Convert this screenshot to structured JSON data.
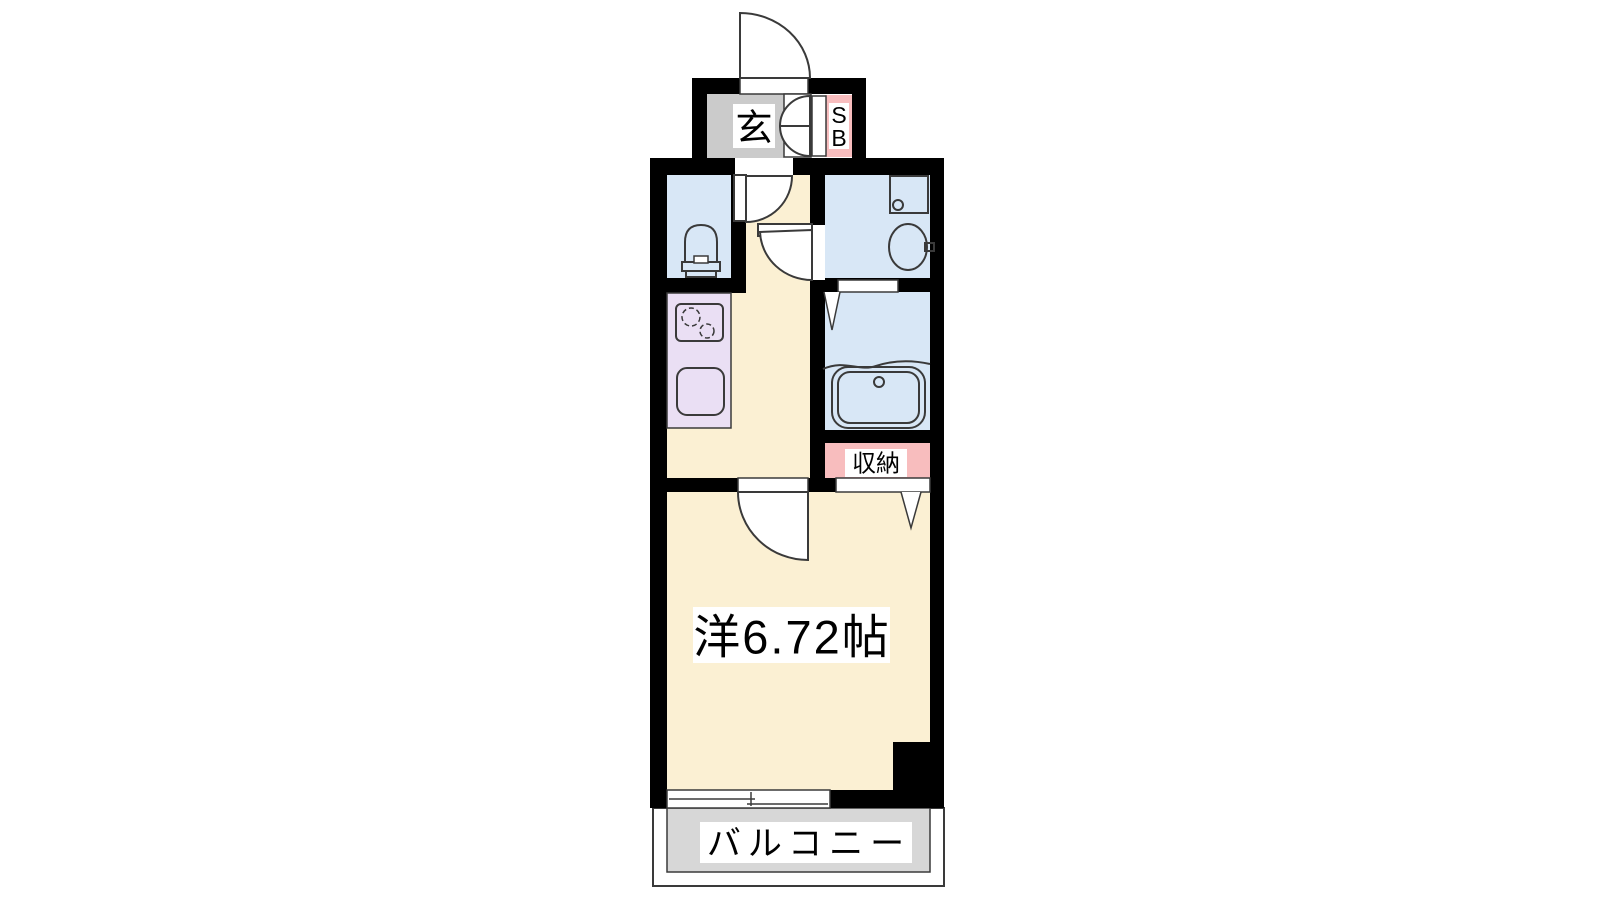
{
  "document": {
    "type": "apartment-floor-plan",
    "background": "#ffffff"
  },
  "colors": {
    "wall": "#000000",
    "floor_cream": "#FBF0D3",
    "wet_blue": "#D8E7F6",
    "kitchen_lavender": "#EADFF4",
    "closet_pink": "#F8BDBE",
    "entry_gray": "#CBCBCB",
    "balcony_gray": "#D7D7D7",
    "outline": "#3A3A3A",
    "label_bg": "#FFFFFF",
    "text": "#000000"
  },
  "labels": {
    "entrance": "玄",
    "shoe_box_line1": "S",
    "shoe_box_line2": "B",
    "storage": "収納",
    "main_room": "洋6.72帖",
    "balcony": "バルコニー"
  },
  "room_sizes": {
    "western_room_jo": 6.72
  },
  "icons": {
    "front_door": "door-swing-icon",
    "interior_doors": "door-swing-icon",
    "shoe_box_doors": "bifold-door-icon",
    "toilet": "toilet-icon",
    "washer_pan": "washing-machine-pan-icon",
    "wash_basin": "sink-icon",
    "bathtub": "bathtub-icon",
    "stove": "two-burner-stove-icon",
    "kitchen_sink": "kitchen-sink-icon",
    "folding_door_mark": "folding-door-mark-icon",
    "balcony_window": "sliding-window-icon"
  }
}
